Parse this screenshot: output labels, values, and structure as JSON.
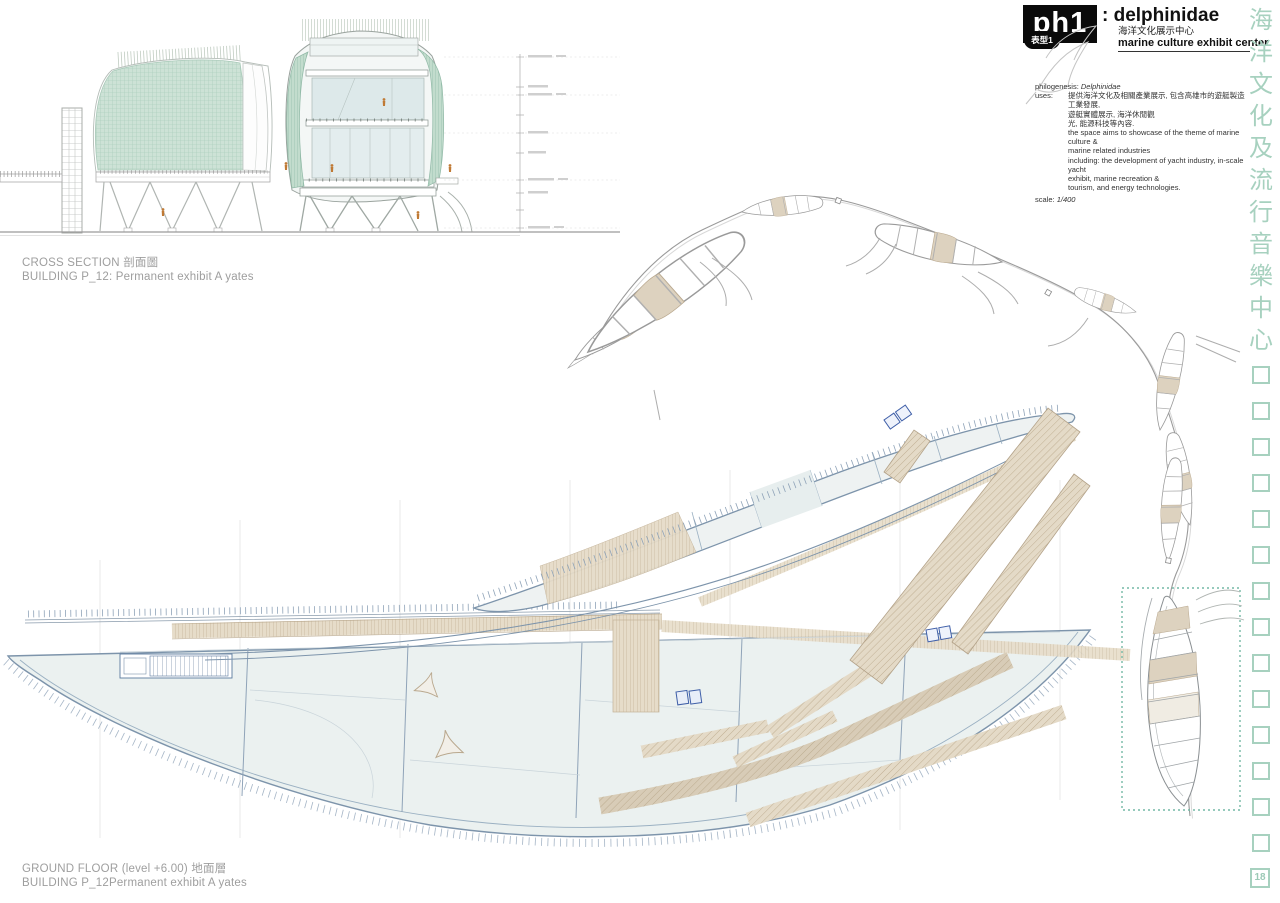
{
  "title_block": {
    "code": "ph1",
    "name": ": delphinidae",
    "subtitle_zh": "海洋文化展示中心",
    "subtitle_en": "marine culture exhibit center",
    "badge": "表型1",
    "philogenesis_label": "philogenesis:",
    "philogenesis_value": "Delphinidae",
    "uses_label": "uses:",
    "uses_zh_lines": [
      "提供海洋文化及相關產業展示, 包含高雄市的遊艇製造工業發展,",
      "遊艇實體展示, 海洋休閒觀",
      "光, 能源科技等內容."
    ],
    "uses_en_lines": [
      "the space aims to showcase of the theme of marine culture &",
      "marine related industries",
      "including: the development of yacht industry, in-scale yacht",
      "exhibit, marine recreation &",
      "tourism, and energy technologies."
    ],
    "scale_label": "scale:",
    "scale_value": "1/400"
  },
  "captions": {
    "section_line1": "CROSS SECTION 剖面圖",
    "section_line2": "BUILDING P_12: Permanent exhibit A yates",
    "plan_line1": "GROUND FLOOR  (level +6.00) 地面層",
    "plan_line2": "BUILDING P_12Permanent exhibit A yates"
  },
  "side_column": {
    "characters": [
      "海",
      "洋",
      "文",
      "化",
      "及",
      "流",
      "行",
      "音",
      "樂",
      "中",
      "心"
    ],
    "empty_square_count": 14,
    "page_number": "18",
    "accent_color": "#a7d1bf"
  },
  "drawings": {
    "cross_section": "cross section of building P_12 permanent exhibit pavilions",
    "site_chain": "arc chain of leaf-shaped pavilions site plan",
    "ground_floor": "ground floor plan with two hull-shaped buildings and timber piers",
    "highlight_box_color": "#74b9a5",
    "beige_color": "#e4dac7",
    "hull_outline_color": "#7d94ab",
    "facade_green": "#cde2d6",
    "figure_orange": "#c07a35"
  }
}
